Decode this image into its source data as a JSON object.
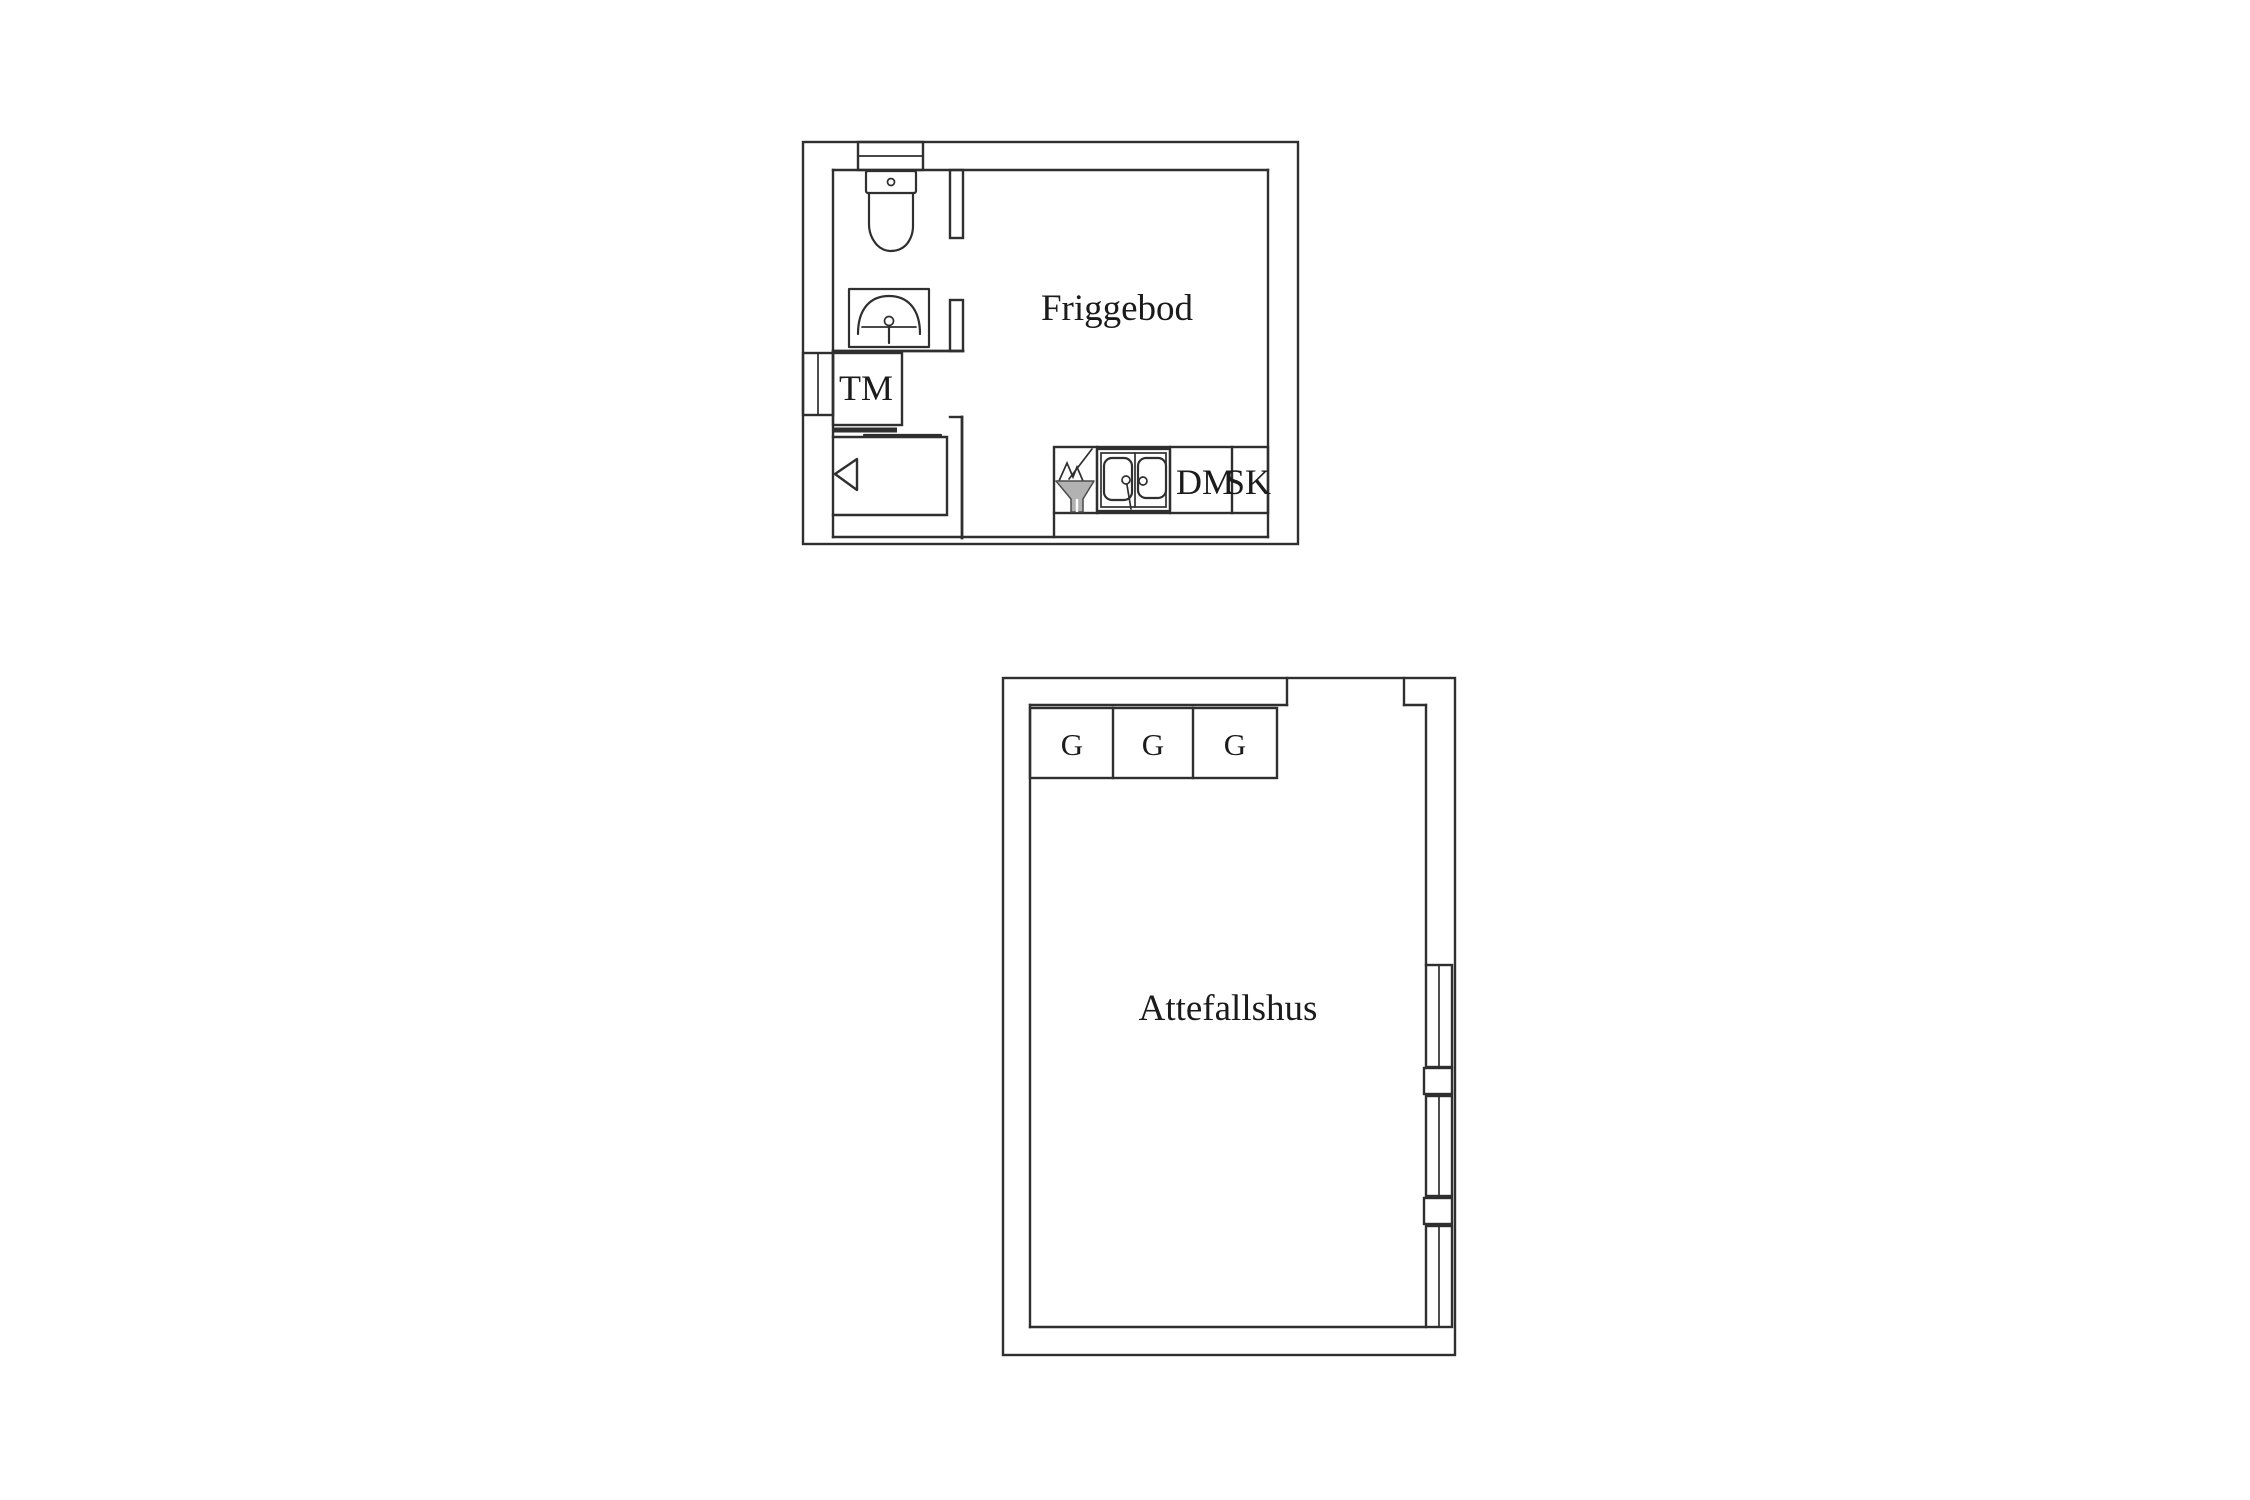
{
  "canvas": {
    "background_color": "#ffffff",
    "ink_color": "#2f2f2f",
    "gray_fixture_color": "#b2b2b2",
    "text_color": "#1b1b1b"
  },
  "plans": {
    "friggebod": {
      "room_label": "Friggebod",
      "washing_machine_label": "TM",
      "dishwasher_label": "DM",
      "cabinet_label": "SK"
    },
    "attefallshus": {
      "room_label": "Attefallshus",
      "wardrobe_labels": [
        "G",
        "G",
        "G"
      ]
    }
  }
}
